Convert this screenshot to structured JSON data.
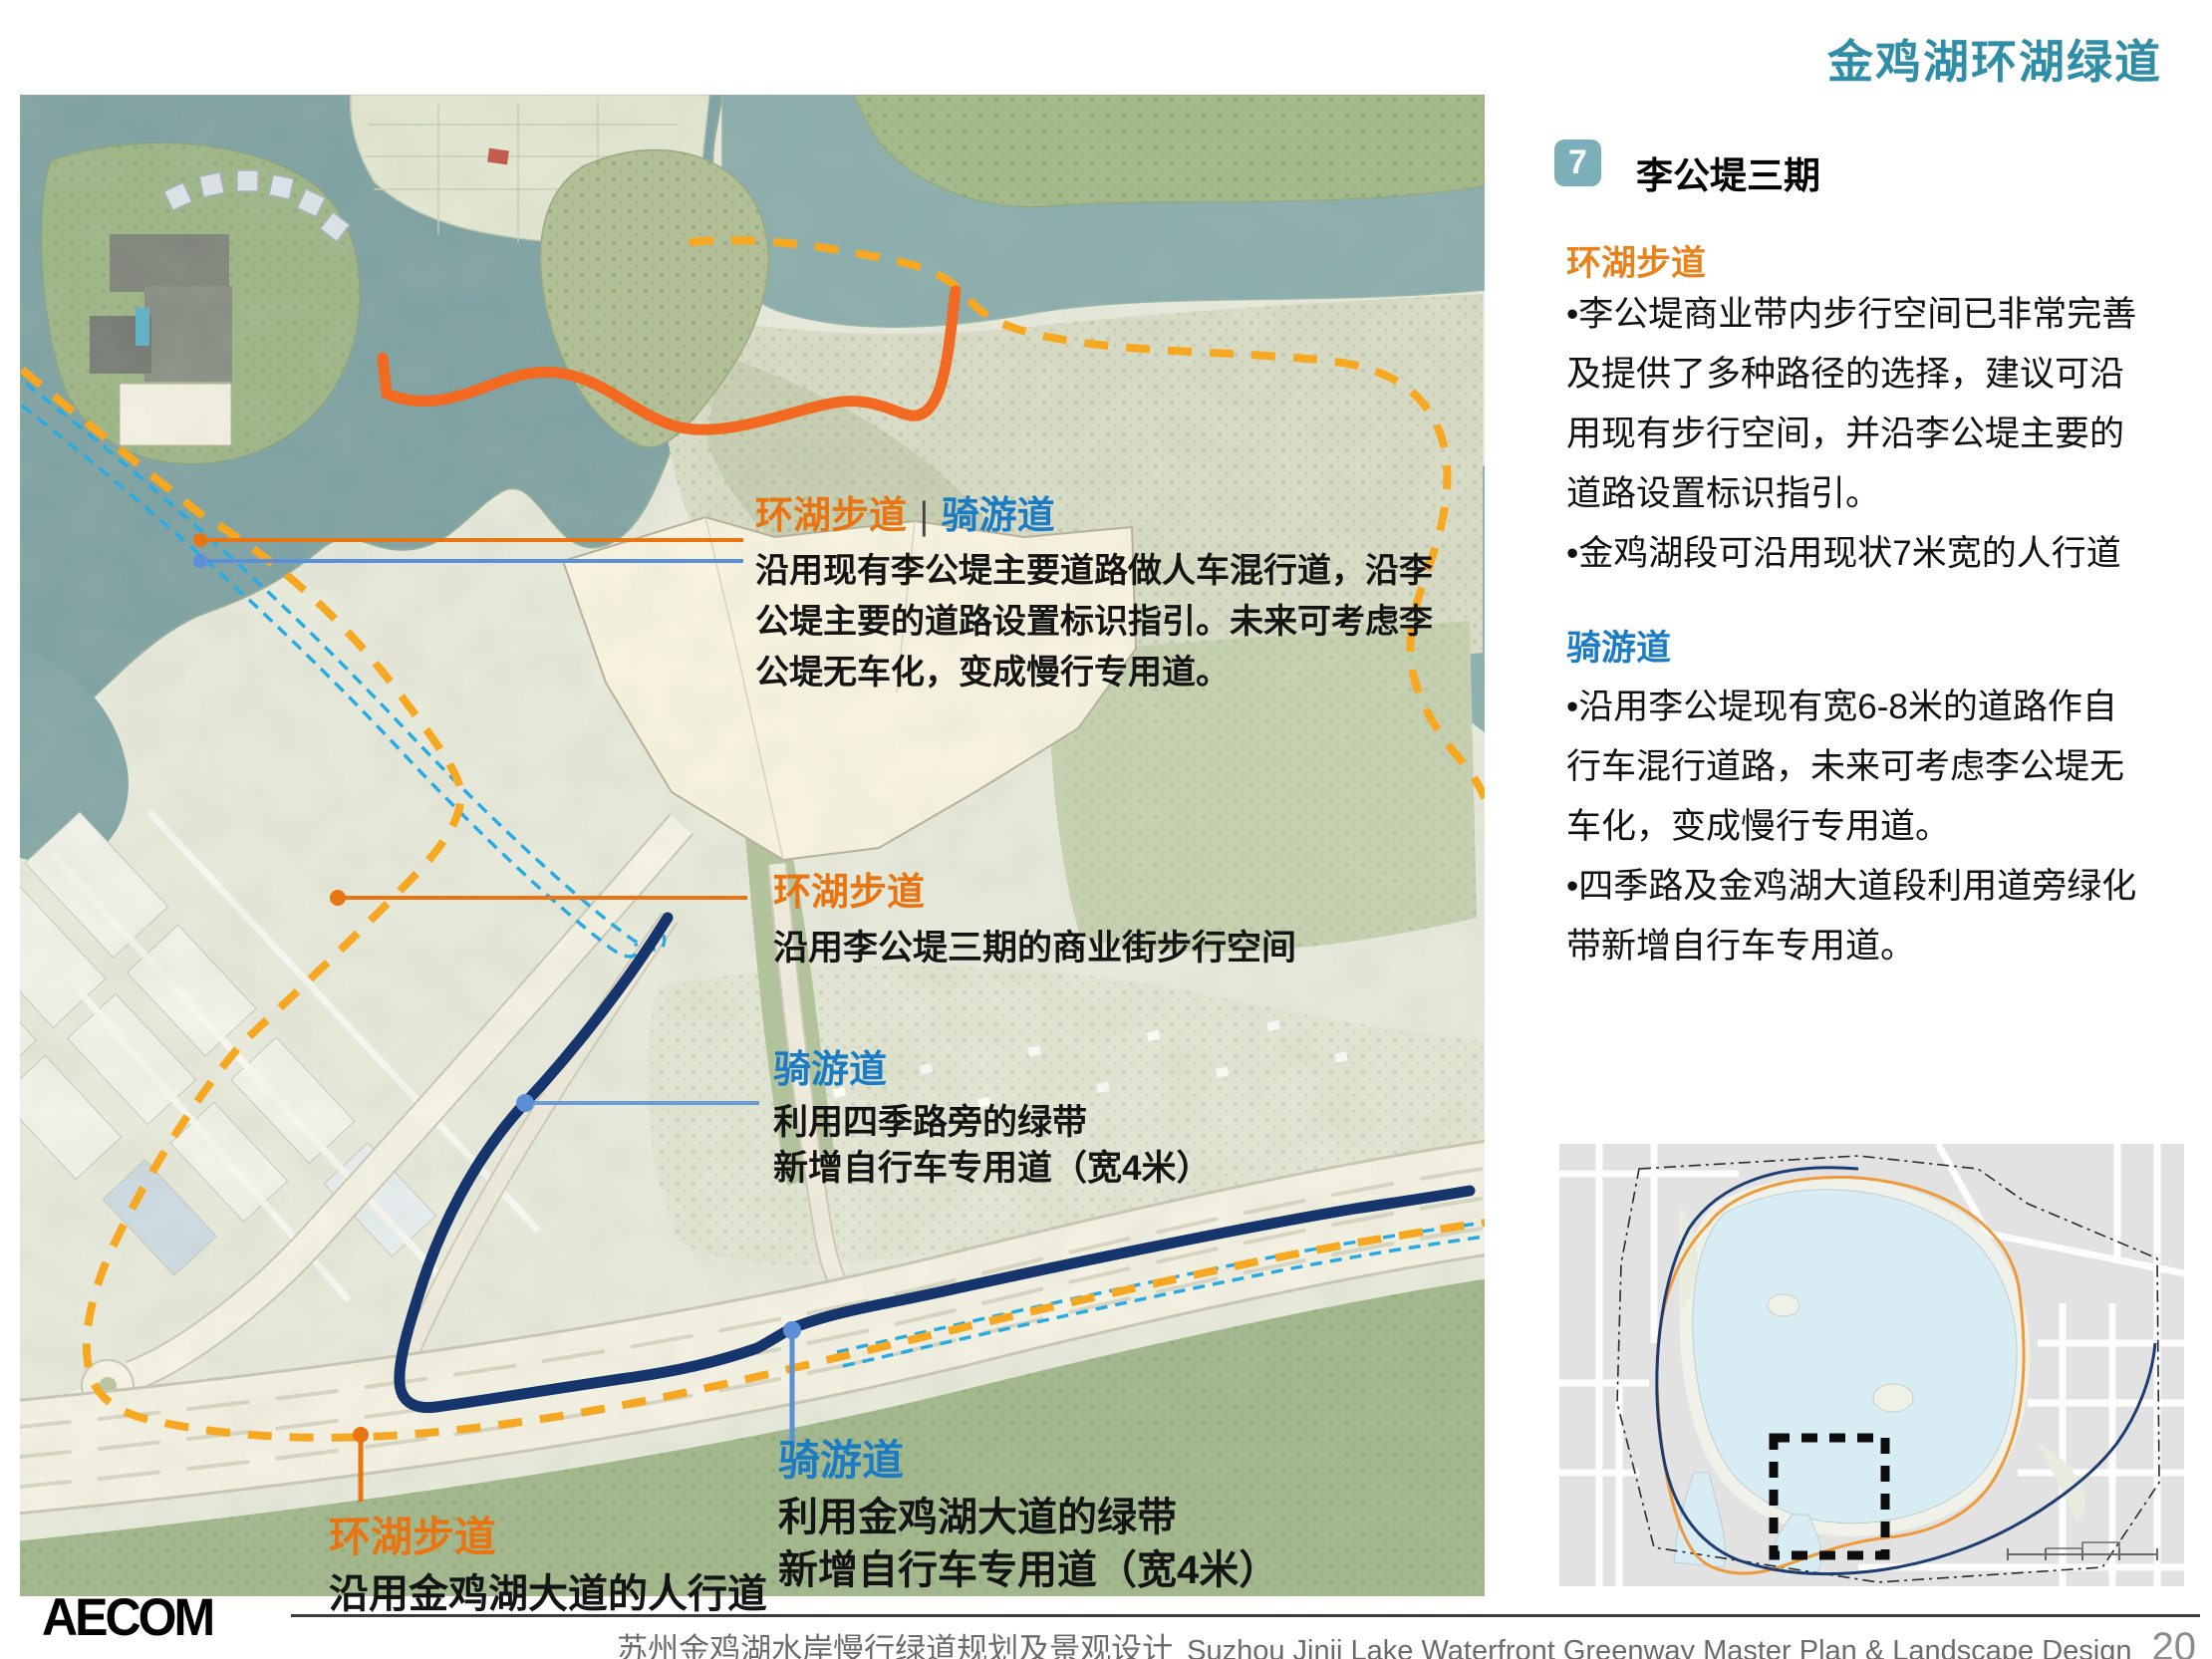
{
  "page": {
    "title": "金鸡湖环湖绿道"
  },
  "panel": {
    "badge": "7",
    "heading": "李公堤三期",
    "walkway": {
      "title": "环湖步道",
      "body": "•李公堤商业带内步行空间已非常完善\n及提供了多种路径的选择，建议可沿\n用现有步行空间，并沿李公堤主要的\n道路设置标识指引。\n•金鸡湖段可沿用现状7米宽的人行道"
    },
    "cycleway": {
      "title": "骑游道",
      "body": "•沿用李公堤现有宽6-8米的道路作自\n行车混行道路，未来可考虑李公堤无\n车化，变成慢行专用道。\n•四季路及金鸡湖大道段利用道旁绿化\n带新增自行车专用道。"
    }
  },
  "map": {
    "annotations": [
      {
        "title_walk": "环湖步道",
        "divider": "|",
        "title_bike": "骑游道",
        "body": "沿用现有李公堤主要道路做人车混行道，沿李\n公堤主要的道路设置标识指引。未来可考虑李\n公堤无车化，变成慢行专用道。"
      },
      {
        "title": "环湖步道",
        "body": "沿用李公堤三期的商业街步行空间"
      },
      {
        "title": "骑游道",
        "body": "利用四季路旁的绿带\n新增自行车专用道（宽4米）"
      },
      {
        "title": "环湖步道",
        "body": "沿用金鸡湖大道的人行道"
      },
      {
        "title": "骑游道",
        "body": "利用金鸡湖大道的绿带\n新增自行车专用道（宽4米）"
      }
    ]
  },
  "footer": {
    "logo": "AECOM",
    "title_cn": "苏州金鸡湖水岸慢行绿道规划及景观设计",
    "title_en": "Suzhou Jinji Lake Waterfront Greenway  Master Plan & Landscape Design",
    "page": "20"
  },
  "colors": {
    "accent_teal": "#2f8da6",
    "badge_teal": "#7bafba",
    "orange_heading": "#e8821c",
    "blue_heading": "#1b7cc4",
    "route_walkway_solid": "#f26a21",
    "route_regional_dashed": "#f7a823",
    "route_cycleway_navy": "#16356d",
    "route_existing_cyan": "#29abe2",
    "leader_blue": "#5b8fd8",
    "water": "#7fa2a3"
  }
}
